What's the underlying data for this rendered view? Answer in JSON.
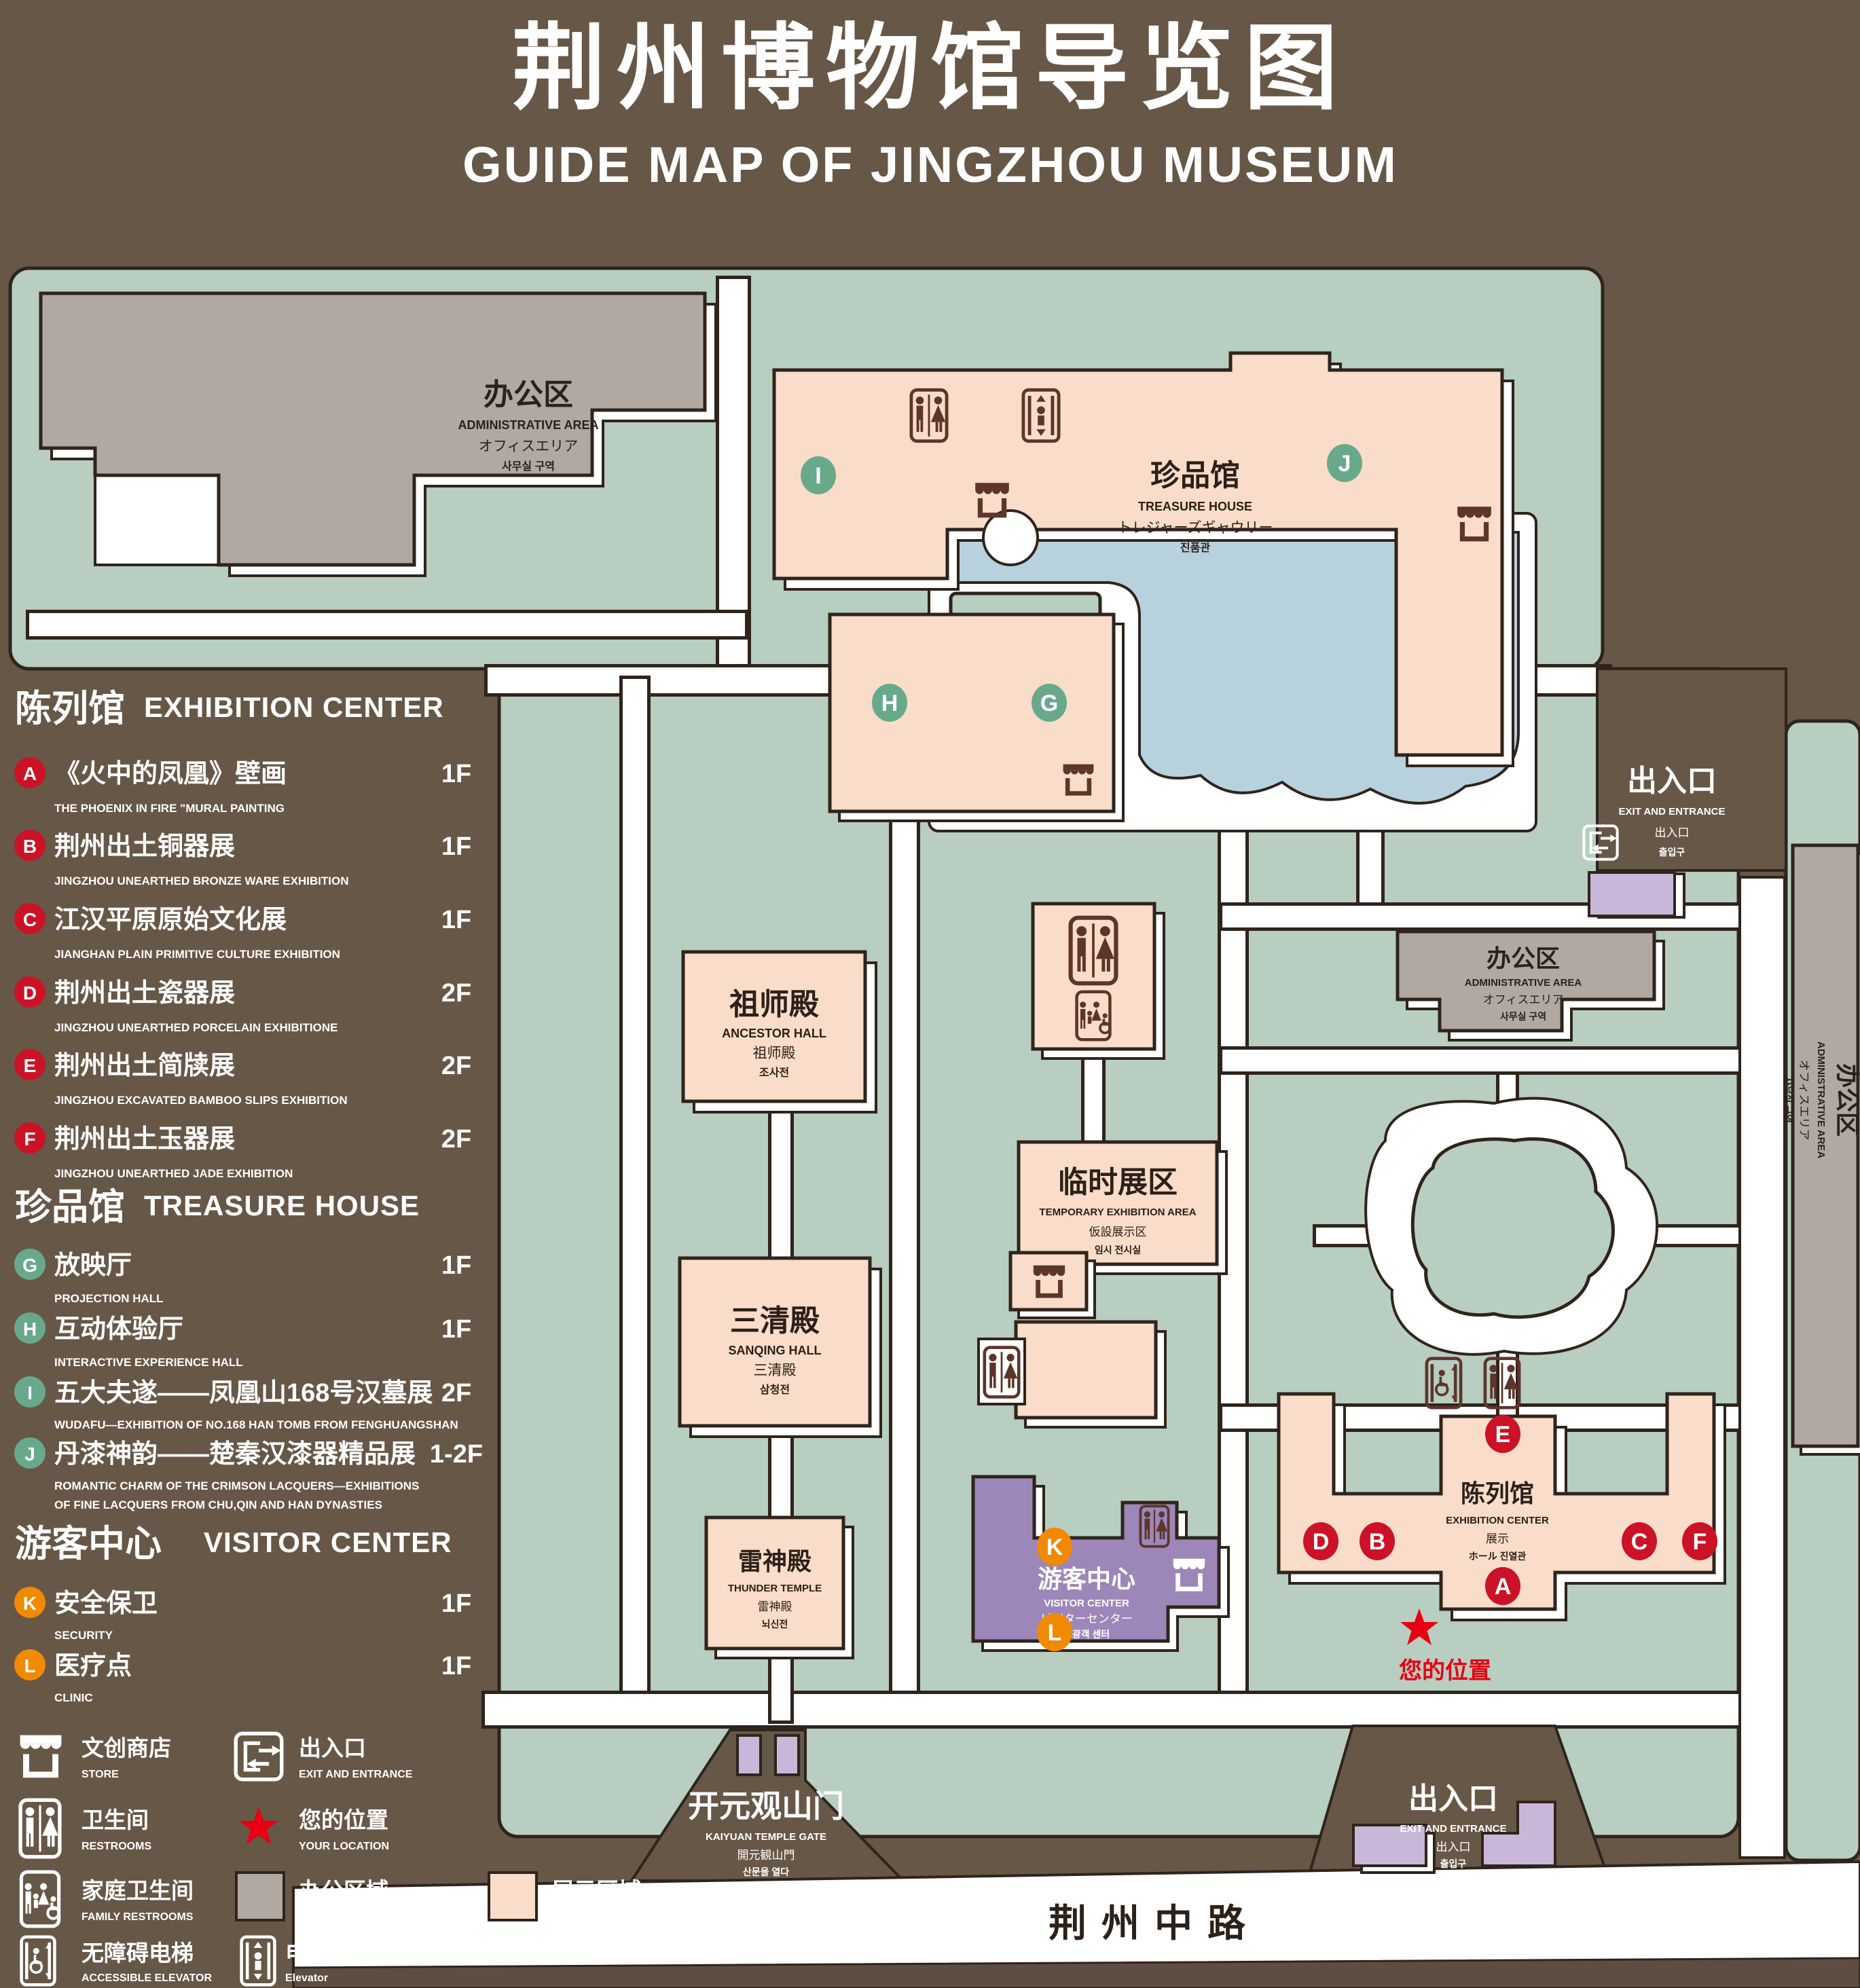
{
  "palette": {
    "background_brown": "#675747",
    "land_green": "#b7cec0",
    "display_area_pink": "#f9dcc9",
    "office_area_gray": "#b1a8a2",
    "visitor_center_purple": "#9c87b8",
    "gate_lavender": "#c9b7d9",
    "pond_blue": "#b7d2dd",
    "badge_red": "#cc1226",
    "badge_green": "#69a98b",
    "badge_orange": "#f18a00",
    "location_red": "#e60012",
    "outline_dark": "#2b2118"
  },
  "title": {
    "zh": "荆州博物馆导览图",
    "en": "GUIDE MAP OF JINGZHOU MUSEUM"
  },
  "legend": {
    "sections": [
      {
        "heading_zh": "陈列馆",
        "heading_en": "EXHIBITION CENTER",
        "items": [
          {
            "letter": "A",
            "zh": "《火中的凤凰》壁画",
            "en": "THE PHOENIX IN FIRE \"MURAL PAINTING",
            "floor": "1F"
          },
          {
            "letter": "B",
            "zh": "荆州出土铜器展",
            "en": "JINGZHOU UNEARTHED BRONZE WARE EXHIBITION",
            "floor": "1F"
          },
          {
            "letter": "C",
            "zh": "江汉平原原始文化展",
            "en": "JIANGHAN PLAIN PRIMITIVE CULTURE EXHIBITION",
            "floor": "1F"
          },
          {
            "letter": "D",
            "zh": "荆州出土瓷器展",
            "en": "JINGZHOU UNEARTHED PORCELAIN EXHIBITIONE",
            "floor": "2F"
          },
          {
            "letter": "E",
            "zh": "荆州出土简牍展",
            "en": "JINGZHOU EXCAVATED BAMBOO SLIPS EXHIBITION",
            "floor": "2F"
          },
          {
            "letter": "F",
            "zh": "荆州出土玉器展",
            "en": "JINGZHOU UNEARTHED JADE EXHIBITION",
            "floor": "2F"
          }
        ]
      },
      {
        "heading_zh": "珍品馆",
        "heading_en": "TREASURE HOUSE",
        "items": [
          {
            "letter": "G",
            "zh": "放映厅",
            "en": "PROJECTION HALL",
            "floor": "1F"
          },
          {
            "letter": "H",
            "zh": "互动体验厅",
            "en": "INTERACTIVE EXPERIENCE HALL",
            "floor": "1F"
          },
          {
            "letter": "I",
            "zh": "五大夫遂——凤凰山168号汉墓展",
            "en": "WUDAFU—EXHIBITION OF NO.168 HAN TOMB FROM FENGHUANGSHAN",
            "floor": "2F"
          },
          {
            "letter": "J",
            "zh": "丹漆神韵——楚秦汉漆器精品展",
            "en": "ROMANTIC CHARM OF THE CRIMSON LACQUERS—EXHIBITIONS",
            "en2": "OF FINE LACQUERS FROM CHU,QIN AND HAN DYNASTIES",
            "floor": "1-2F"
          }
        ]
      },
      {
        "heading_zh": "游客中心",
        "heading_en": "VISITOR CENTER",
        "items": [
          {
            "letter": "K",
            "zh": "安全保卫",
            "en": "SECURITY",
            "floor": "1F"
          },
          {
            "letter": "L",
            "zh": "医疗点",
            "en": "CLINIC",
            "floor": "1F"
          }
        ]
      }
    ],
    "symbols": [
      {
        "icon": "store-icon",
        "zh": "文创商店",
        "en": "STORE"
      },
      {
        "icon": "restrooms-icon",
        "zh": "卫生间",
        "en": "RESTROOMS"
      },
      {
        "icon": "family-restrooms-icon",
        "zh": "家庭卫生间",
        "en": "FAMILY RESTROOMS"
      },
      {
        "icon": "accessible-elevator-icon",
        "zh": "无障碍电梯",
        "en": "ACCESSIBLE ELEVATOR"
      },
      {
        "icon": "elevator-icon",
        "zh": "电梯",
        "en": "Elevator"
      },
      {
        "icon": "exit-entrance-icon",
        "zh": "出入口",
        "en": "EXIT AND ENTRANCE"
      },
      {
        "icon": "your-location-star",
        "zh": "您的位置",
        "en": "YOUR LOCATION"
      },
      {
        "icon": "office-area-swatch",
        "zh": "办公区域",
        "en": "OFFICE AREA"
      },
      {
        "icon": "display-area-swatch",
        "zh": "展示区域",
        "en": "DISPLAY AREA"
      }
    ]
  },
  "map": {
    "labels": {
      "admin_tl": [
        "办公区",
        "ADMINISTRATIVE AREA",
        "オフィスエリア",
        "사무실 구역"
      ],
      "treasure": [
        "珍品馆",
        "TREASURE HOUSE",
        "トレジャーズギャウリー",
        "진품관"
      ],
      "ancestor": [
        "祖师殿",
        "ANCESTOR HALL",
        "祖师殿",
        "조사전"
      ],
      "temporary": [
        "临时展区",
        "TEMPORARY EXHIBITION AREA",
        "仮設展示区",
        "임시 전시실"
      ],
      "sanqing": [
        "三清殿",
        "SANQING HALL",
        "三清殿",
        "삼청전"
      ],
      "thunder": [
        "雷神殿",
        "THUNDER TEMPLE",
        "雷神殿",
        "뇌신전"
      ],
      "visitor": [
        "游客中心",
        "VISITOR CENTER",
        "ビジターセンター",
        "관광객 센터"
      ],
      "exhibition": [
        "陈列馆",
        "EXHIBITION CENTER",
        "展示",
        "ホール 진열관"
      ],
      "admin_right": [
        "办公区",
        "ADMINISTRATIVE AREA",
        "オフィスエリア",
        "사무실 구역"
      ],
      "admin_strip": [
        "办公区",
        "ADMINISTRATIVE AREA",
        "オフィスエリア",
        "사무실 구역"
      ],
      "kaiyuan": [
        "开元观山门",
        "KAIYUAN TEMPLE GATE",
        "開元観山門",
        "산문을 열다"
      ],
      "exit_right": [
        "出入口",
        "EXIT AND ENTRANCE",
        "出入口",
        "출입구"
      ],
      "exit_bottom": [
        "出入口",
        "EXIT AND ENTRANCE",
        "出入口",
        "출입구"
      ]
    },
    "road": {
      "name": "荆州中路"
    },
    "your_location": {
      "zh": "您的位置"
    },
    "badge_letters": [
      "A",
      "B",
      "C",
      "D",
      "E",
      "F",
      "G",
      "H",
      "I",
      "J",
      "K",
      "L"
    ]
  }
}
